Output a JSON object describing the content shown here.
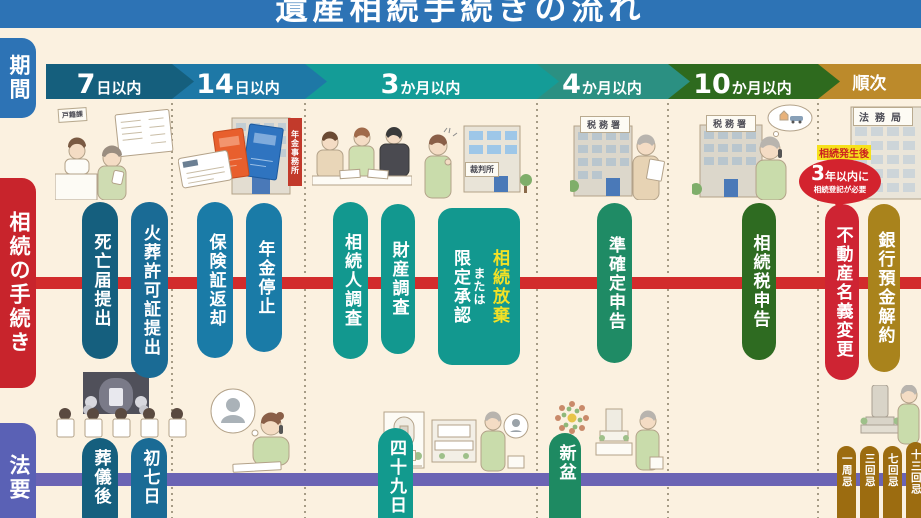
{
  "title": "遺産相続手続きの流れ",
  "colors": {
    "background": "#fbf1e0",
    "banner": "#2d73b5",
    "procedure_axis": "#d22c2c",
    "memorial_axis": "#6b64b4"
  },
  "sidebar": {
    "items": [
      {
        "label": "期間",
        "color": "#2d73b5"
      },
      {
        "label": "相続の手続き",
        "color": "#c8242c"
      },
      {
        "label": "法要",
        "color": "#5a61b5"
      }
    ]
  },
  "timeline": {
    "segments": [
      {
        "num": "7",
        "unit": "日以内",
        "color": "#155f7d"
      },
      {
        "num": "14",
        "unit": "日以内",
        "color": "#1e78a6"
      },
      {
        "num": "3",
        "unit": "か月以内",
        "color": "#149c97"
      },
      {
        "num": "4",
        "unit": "か月以内",
        "color": "#2b9082"
      },
      {
        "num": "10",
        "unit": "か月以内",
        "color": "#2e6a1e"
      },
      {
        "num": "",
        "unit": "順次",
        "color": "#bc8a2b"
      }
    ]
  },
  "procedures": {
    "items": [
      {
        "label": "死亡届提出",
        "color": "#155f7e"
      },
      {
        "label": "火葬許可証提出",
        "color": "#1a6b95"
      },
      {
        "label": "保険証返却",
        "color": "#1a7ba7"
      },
      {
        "label": "年金停止",
        "color": "#1a7ba7"
      },
      {
        "label": "相続人調査",
        "color": "#12988f"
      },
      {
        "label": "財産調査",
        "color": "#12988f"
      },
      {
        "main": "相続放棄",
        "or": "または",
        "alt": "限定承認",
        "color": "#12988f",
        "main_color": "#f2e126"
      },
      {
        "label": "準確定申告",
        "color": "#1f8b65"
      },
      {
        "label": "相続税申告",
        "color": "#2e6b21"
      },
      {
        "label": "不動産名義変更",
        "color": "#ce2433"
      },
      {
        "label": "銀行預金解約",
        "color": "#a9831c"
      }
    ]
  },
  "callout": {
    "condition": "相続発生後",
    "deadline_num": "3",
    "deadline_rest": "年以内に",
    "note": "相続登記が必要",
    "bubble_color": "#d3232e",
    "highlight_color": "#f6e11c"
  },
  "memorials": {
    "items": [
      {
        "label": "葬儀後",
        "color": "#155f7e"
      },
      {
        "label": "初七日",
        "color": "#1a6b95"
      },
      {
        "label": "四十九日",
        "color": "#129a8e"
      },
      {
        "label": "新盆",
        "color": "#1e8a62"
      },
      {
        "label": "一周忌",
        "color": "#9c6c10"
      },
      {
        "label": "三回忌",
        "color": "#9c6c10"
      },
      {
        "label": "七回忌",
        "color": "#9c6c10"
      },
      {
        "label": "十三回忌",
        "color": "#9c6c10"
      }
    ]
  },
  "illustrations": {
    "koseki_sign": "戸籍課",
    "pension_office": "年金事務所",
    "court": "裁判所",
    "tax_office": "税務署",
    "legal_bureau": "法務局",
    "columbarium": "納骨堂"
  }
}
